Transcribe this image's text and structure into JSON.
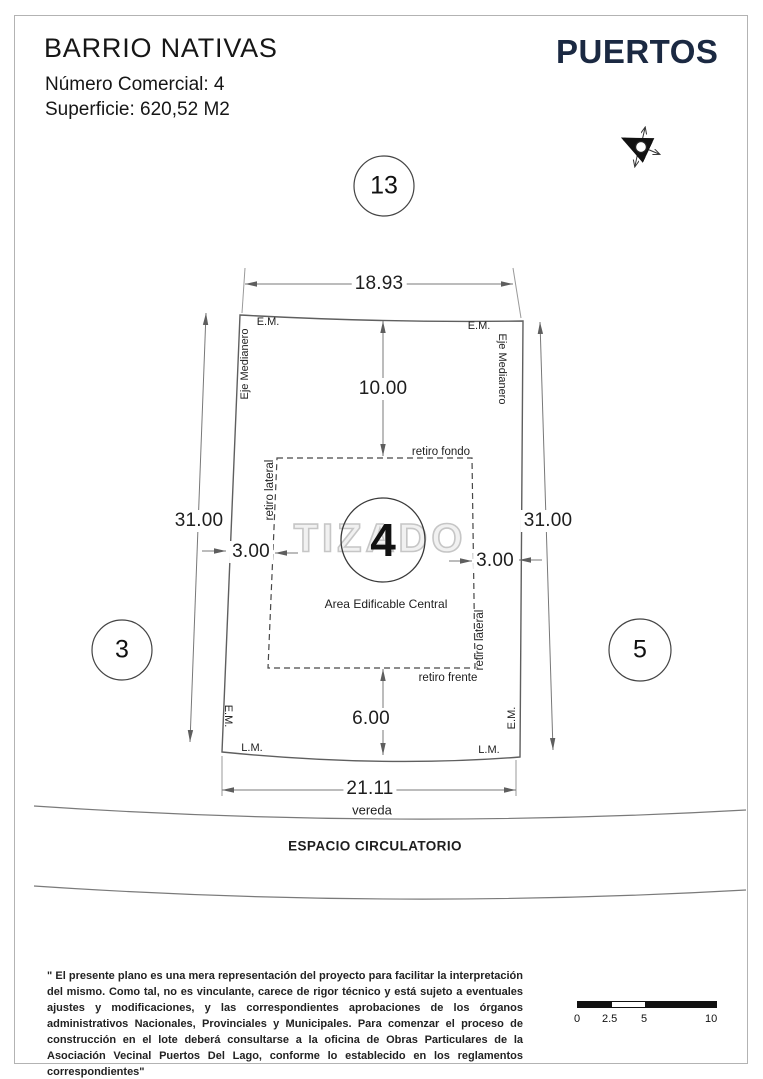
{
  "header": {
    "title": "BARRIO NATIVAS",
    "commercial_number": "Número Comercial: 4",
    "surface": "Superficie: 620,52 M2",
    "brand": "PUERTOS"
  },
  "icons": {
    "compass": "north-arrow-icon"
  },
  "plan": {
    "lot_number": "4",
    "neighbors": {
      "top": "13",
      "left": "3",
      "right": "5"
    },
    "dimensions": {
      "top": "18.93",
      "bottom": "21.11",
      "left": "31.00",
      "right": "31.00",
      "rear_setback": "10.00",
      "front_setback": "6.00",
      "side_setback_left": "3.00",
      "side_setback_right": "3.00"
    },
    "labels": {
      "em": "E.M.",
      "lm": "L.M.",
      "eje_medianero": "Eje Medianero",
      "retiro_fondo": "retiro fondo",
      "retiro_frente": "retiro frente",
      "retiro_lateral": "retiro lateral",
      "area_edificable": "Area Edificable Central",
      "vereda": "vereda",
      "espacio_circulatorio": "ESPACIO CIRCULATORIO"
    },
    "watermark": "TIZADO"
  },
  "scale_bar": {
    "ticks": [
      "0",
      "2.5",
      "5",
      "10"
    ]
  },
  "disclaimer": "\" El presente plano es una mera representación del proyecto para facilitar la interpretación del mismo. Como tal, no es vinculante, carece de rigor técnico y está sujeto a eventuales ajustes y modificaciones, y las correspondientes aprobaciones de los órganos administrativos Nacionales, Provinciales y Municipales. Para comenzar el proceso de construcción en el lote deberá consultarse a la oficina de Obras Particulares de la Asociación Vecinal Puertos Del Lago, conforme lo establecido en los reglamentos correspondientes\""
}
